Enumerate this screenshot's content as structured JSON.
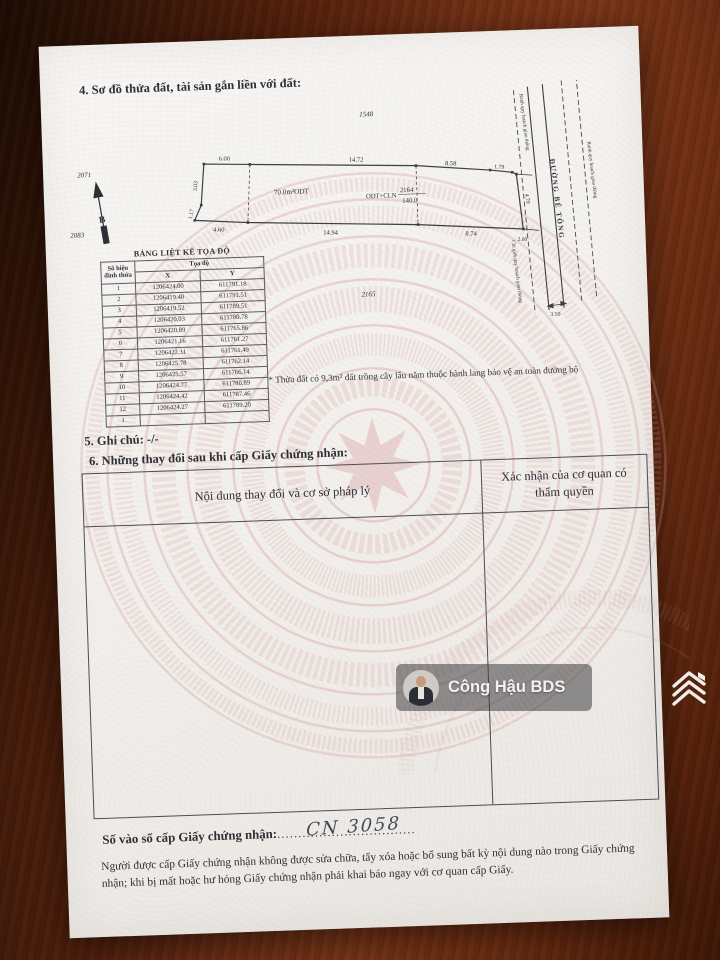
{
  "colors": {
    "wood_brown": "#6e2e12",
    "paper": "#f4f1ed",
    "emblem_pink": "#d69898",
    "ink": "#2e2e36",
    "watermark_bar": "#3e3e40"
  },
  "page": {
    "section4_heading": "4. Sơ đồ thửa đất, tài sản gắn liền với đất:",
    "diagram": {
      "north_label": "B",
      "adjacent_parcels": {
        "top": "1548",
        "upper_left": "2071",
        "lower_left": "2083",
        "bottom": "2165"
      },
      "parcel": {
        "number": "2164",
        "land_type": "ODT+CLN",
        "area": "140.0",
        "sub_area_label": "70.0m²ODT"
      },
      "measurements": {
        "top": [
          "6.00",
          "14.72",
          "8.58",
          "1.79"
        ],
        "bottom": [
          "4.60",
          "14.94",
          "8.74",
          "2.00"
        ],
        "left": [
          "3.03",
          "1.17"
        ],
        "right": [
          "4.70"
        ],
        "road_width": "3.50"
      },
      "road": {
        "name": "ĐƯỜNG BÊ TÔNG",
        "boundary_left_upper": "Ranh quy hoạch giao thông",
        "boundary_left_lower": "Chỉ giới quy hoạch giao thông",
        "boundary_right": "Ranh quy hoạch giao thông"
      },
      "note": "* Thửa đất có 9,3m² đất trồng cây lâu năm thuộc hành lang bảo vệ an toàn đường bộ"
    },
    "coords_table": {
      "title": "BẢNG LIỆT KÊ TỌA ĐỘ",
      "col_point": "Số hiệu đỉnh thửa",
      "col_coords": "Tọa độ",
      "col_x": "X",
      "col_y": "Y",
      "rows": [
        [
          "1",
          "1206424.00",
          "611791.18"
        ],
        [
          "2",
          "1206419.40",
          "611791.51"
        ],
        [
          "3",
          "1206419.52",
          "611789.51"
        ],
        [
          "4",
          "1206420.03",
          "611780.78"
        ],
        [
          "5",
          "1206420.89",
          "611765.86"
        ],
        [
          "6",
          "1206421.16",
          "611761.27"
        ],
        [
          "7",
          "1206422.31",
          "611761.49"
        ],
        [
          "8",
          "1206425.78",
          "611762.14"
        ],
        [
          "9",
          "1206425.57",
          "611766.14"
        ],
        [
          "10",
          "1206424.77",
          "611780.89"
        ],
        [
          "11",
          "1206424.42",
          "611787.46"
        ],
        [
          "12",
          "1206424.27",
          "611789.20"
        ],
        [
          "1",
          "",
          ""
        ]
      ]
    },
    "section5_text": "5. Ghi chú: -/-",
    "section6_heading": "6. Những thay đổi sau khi cấp Giấy chứng nhận:",
    "changes_table": {
      "col_left": "Nội dung thay đổi và cơ sở pháp lý",
      "col_right": "Xác nhận của cơ quan có thẩm quyền"
    },
    "registry": {
      "label": "Số vào sổ cấp Giấy chứng nhận:",
      "dots_left": "..........",
      "value": "CN 3058",
      "dots_right": "......................."
    },
    "footer_note": "Người được cấp Giấy chứng nhận không được sửa chữa, tẩy xóa hoặc bổ sung bất kỳ nội dung nào trong Giấy chứng nhận; khi bị mất hoặc hư hỏng Giấy chứng nhận phải khai báo ngay với cơ quan cấp Giấy."
  },
  "overlay": {
    "watermark_name": "Công Hậu BDS"
  }
}
